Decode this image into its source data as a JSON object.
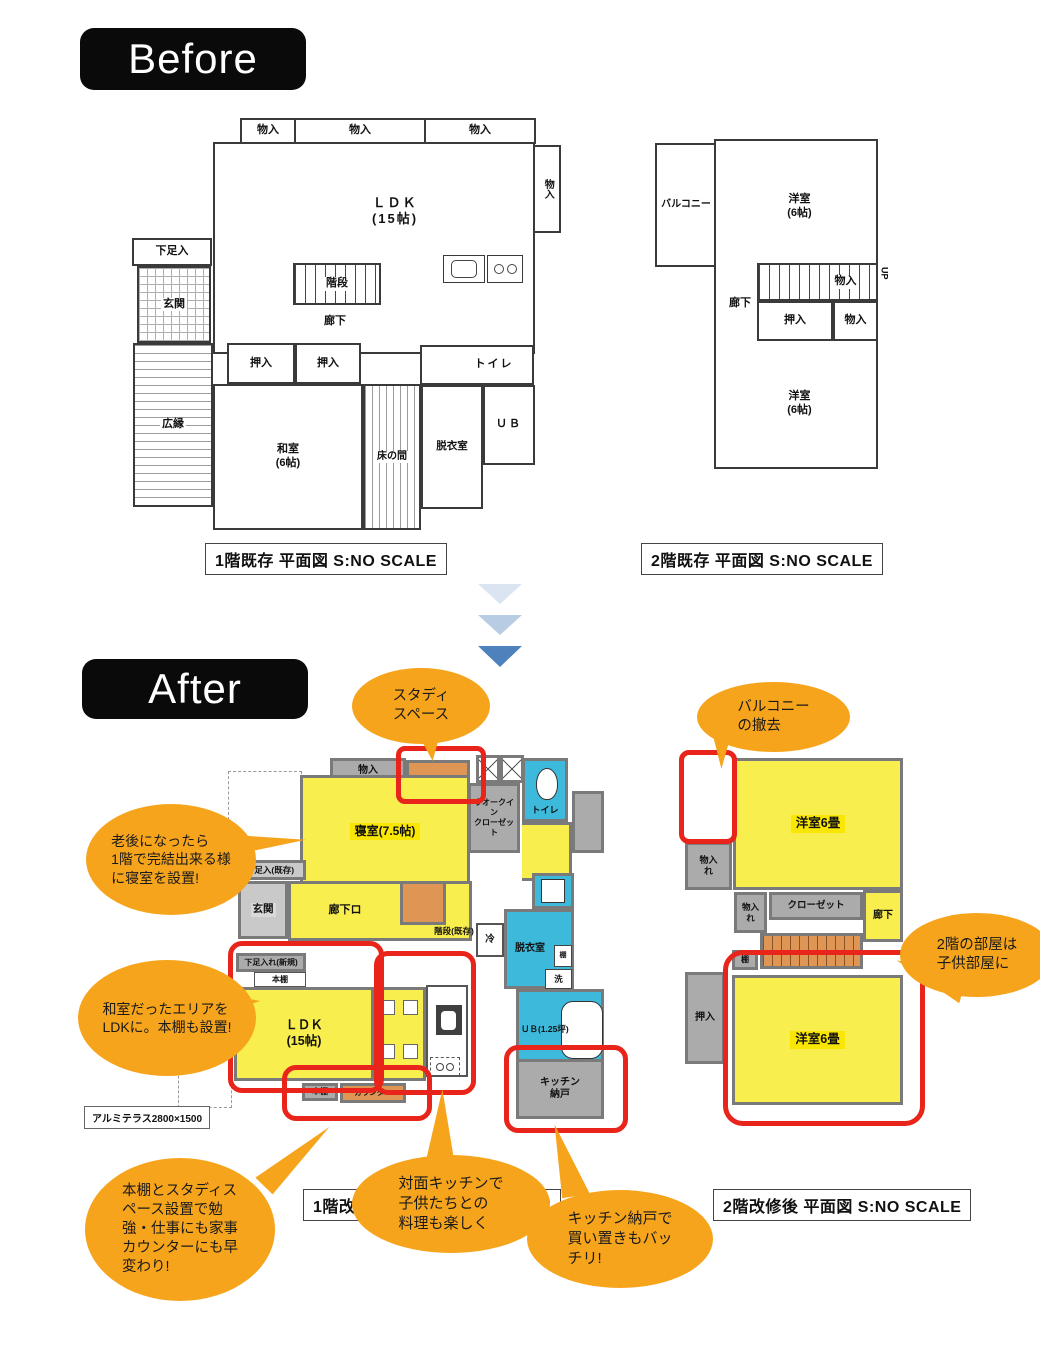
{
  "colors": {
    "badge_bg": "#0a0a0a",
    "room_yellow": "#f8ee4d",
    "label_yellow": "#f9e602",
    "closet_gray": "#ababab",
    "wet_cyan": "#3cb9db",
    "accent_orange": "#df9554",
    "highlight_red": "#e8241b",
    "bubble_orange": "#f7a41d",
    "arrow_light": "#dbe5f1",
    "arrow_mid": "#b8cce4",
    "arrow_dark": "#4f81bd"
  },
  "before": {
    "badge": "Before",
    "f1": {
      "caption": "1階既存 平面図 S:NO SCALE",
      "storage1": "物入",
      "storage2": "物入",
      "storage3": "物入",
      "storage_right": "物入",
      "ldk": "ＬＤＫ\n(15帖)",
      "geta": "下足入",
      "genkan": "玄関",
      "kaidan": "階段",
      "rouka": "廊下",
      "oshiire1": "押入",
      "oshiire2": "押入",
      "toilet": "トイレ",
      "hiroen": "広縁",
      "washitsu": "和室\n(6帖)",
      "tokonoma": "床の間",
      "datsuishitsu": "脱衣室",
      "ub": "ＵＢ"
    },
    "f2": {
      "caption": "2階既存 平面図 S:NO SCALE",
      "balcony": "バルコニー",
      "yoshitsu_top": "洋室\n(6帖)",
      "rouka": "廊下",
      "monoiri_stair": "物入",
      "up": "UP",
      "oshiire": "押入",
      "monoiri": "物入",
      "yoshitsu_bottom": "洋室\n(6帖)"
    }
  },
  "after": {
    "badge": "After",
    "f1": {
      "caption": "1階改修後 平面図 S:NO SCALE",
      "monoiri": "物入",
      "shinshitsu": "寝室(7.5帖)",
      "wic": "ウオークイン\nクローゼット",
      "toilet": "トイレ",
      "geta_kison": "下足入(既存)",
      "genkan": "玄関",
      "rouka": "廊下ロ",
      "kaidan_kison": "階段(既存)",
      "rei": "冷",
      "datsuishitsu": "脱衣室",
      "tana": "棚",
      "sen": "洗",
      "geta_shinki": "下足入れ(新規)",
      "hondana_top": "本棚",
      "ldk": "ＬＤＫ\n(15帖)",
      "ub": "ＵＢ(1.25坪)",
      "hondana_bottom": "本棚",
      "counter": "カウンター",
      "pantry": "キッチン\n納戸",
      "terrace": "アルミテラス2800×1500"
    },
    "f2": {
      "caption": "2階改修後 平面図 S:NO SCALE",
      "yoshitsu_top": "洋室6畳",
      "monoire1": "物入\nれ",
      "monoire2": "物入\nれ",
      "closet": "クローゼット",
      "rouka": "廊下",
      "tana": "棚",
      "oshiire": "押入",
      "yoshitsu_bottom": "洋室6畳"
    }
  },
  "bubbles": {
    "study": "スタディ\nスペース",
    "balcony_removal": "バルコニー\nの撤去",
    "bedroom": "老後になったら\n1階で完結出来る様\nに寝室を設置!",
    "ldk": "和室だったエリアを\nLDKに。本棚も設置!",
    "bookshelf": "本棚とスタディス\nペース設置で勉\n強・仕事にも家事\nカウンターにも早\n変わり!",
    "kitchen": "対面キッチンで\n子供たちとの\n料理も楽しく",
    "pantry": "キッチン納戸で\n買い置きもバッ\nチリ!",
    "kids_room": "2階の部屋は\n子供部屋に"
  }
}
